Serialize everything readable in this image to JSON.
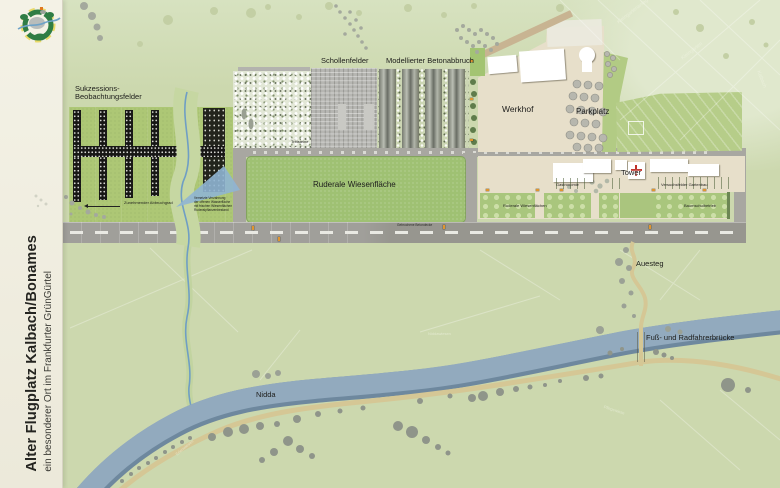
{
  "panel": {
    "title": "Alter Flugplatz Kalbach/Bonames",
    "subtitle": "ein besonderer Ort im Frankfurter GrünGürtel"
  },
  "map": {
    "areas": {
      "sukzession": "Sukzessions-\nBeobachtungsfelder",
      "schollenfelder": "Schollenfelder",
      "betonabbruch": "Modellierter Betonabbruch",
      "ruderale": "Ruderale Wiesenfläche",
      "werkhof": "Werkhof",
      "parkplatz": "Parkplatz",
      "tower": "Tower"
    },
    "annotations": {
      "abbruchgrad": "Zunehmender Abbruchgrad",
      "trittsteine": "Trittsteine",
      "stream_note": "Vernetzte Verzahnung\nder offenen Wasserfläche\nmit frischen Wiesenflächen\nRuderalpflanzenbestand",
      "runway_note": "Gebrochene Betondecke",
      "gastronomie": "Gastronomie",
      "gartenbau": "Versuchsfelder Gartenbau",
      "wiesenflaechen": "Ruderale Wiesenflächen",
      "baumschule": "Baumschulbetrieb"
    },
    "places": {
      "nidda": "Nidda",
      "auesteg": "Auesteg",
      "bruecke": "Fuß- und Radfahrerbrücke",
      "kleingartenanlage": "Kleingartenanlage",
      "kleingaerten": "Kleingärten",
      "kalbach": "Kalbach",
      "niddawiesen": "Niddawiesen",
      "pflegewiese": "Pflegewiese",
      "erlenwiesen": "Erlenwiesen"
    },
    "colors": {
      "map_green": "#cfdcb2",
      "field_green": "#adc775",
      "meadow_green": "#9fc173",
      "werkhof_beige": "#e7dfca",
      "runway_grey": "#9c9b95",
      "river_blue": "#92aabe",
      "path_tan": "#d5c795",
      "marker_orange": "#e0952f",
      "tower_cross_red": "#c03028"
    }
  }
}
